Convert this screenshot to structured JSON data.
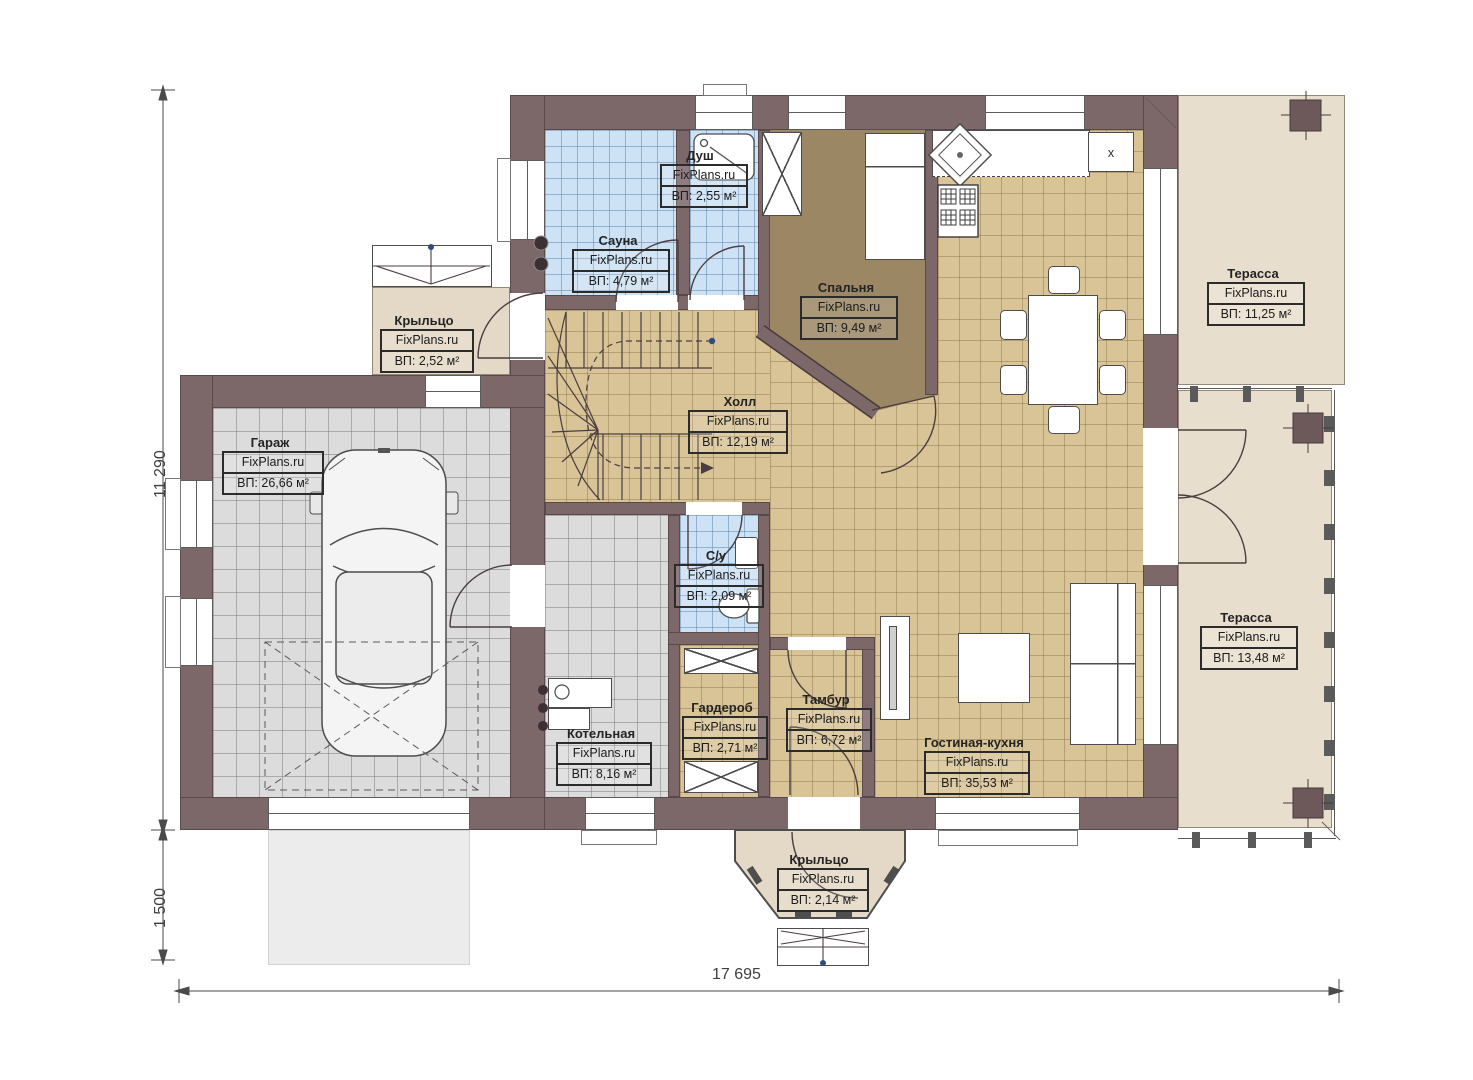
{
  "watermark": "FixPlans.ru",
  "dimensions": {
    "height_main": "11 290",
    "height_porch": "1 500",
    "width_total": "17 695"
  },
  "rooms": [
    {
      "name": "Душ",
      "area": "ВП: 2,55 м²"
    },
    {
      "name": "Сауна",
      "area": "ВП: 4,79 м²"
    },
    {
      "name": "Крыльцо",
      "area": "ВП: 2,52 м²"
    },
    {
      "name": "Спальня",
      "area": "ВП: 9,49 м²"
    },
    {
      "name": "Терасса",
      "area": "ВП: 11,25 м²"
    },
    {
      "name": "Гараж",
      "area": "ВП: 26,66 м²"
    },
    {
      "name": "Холл",
      "area": "ВП: 12,19 м²"
    },
    {
      "name": "С/у",
      "area": "ВП: 2,09 м²"
    },
    {
      "name": "Терасса",
      "area": "ВП: 13,48 м²"
    },
    {
      "name": "Котельная",
      "area": "ВП: 8,16 м²"
    },
    {
      "name": "Гардероб",
      "area": "ВП: 2,71 м²"
    },
    {
      "name": "Тамбур",
      "area": "ВП: 6,72 м²"
    },
    {
      "name": "Гостиная-кухня",
      "area": "ВП: 35,53 м²"
    },
    {
      "name": "Крыльцо",
      "area": "ВП: 2,14 м²"
    }
  ],
  "fixtures": {
    "fridge_mark": "x"
  },
  "colors": {
    "wall": "#7c6769",
    "floor_tile_tan": "#d8c496",
    "floor_tile_gray": "#dcdcdc",
    "floor_tile_blue": "#cde2f5",
    "floor_bedroom": "#9c8764",
    "terrace": "#e8decd",
    "porch": "#e4d9c6",
    "marker_dot": "#2f4d7e"
  }
}
